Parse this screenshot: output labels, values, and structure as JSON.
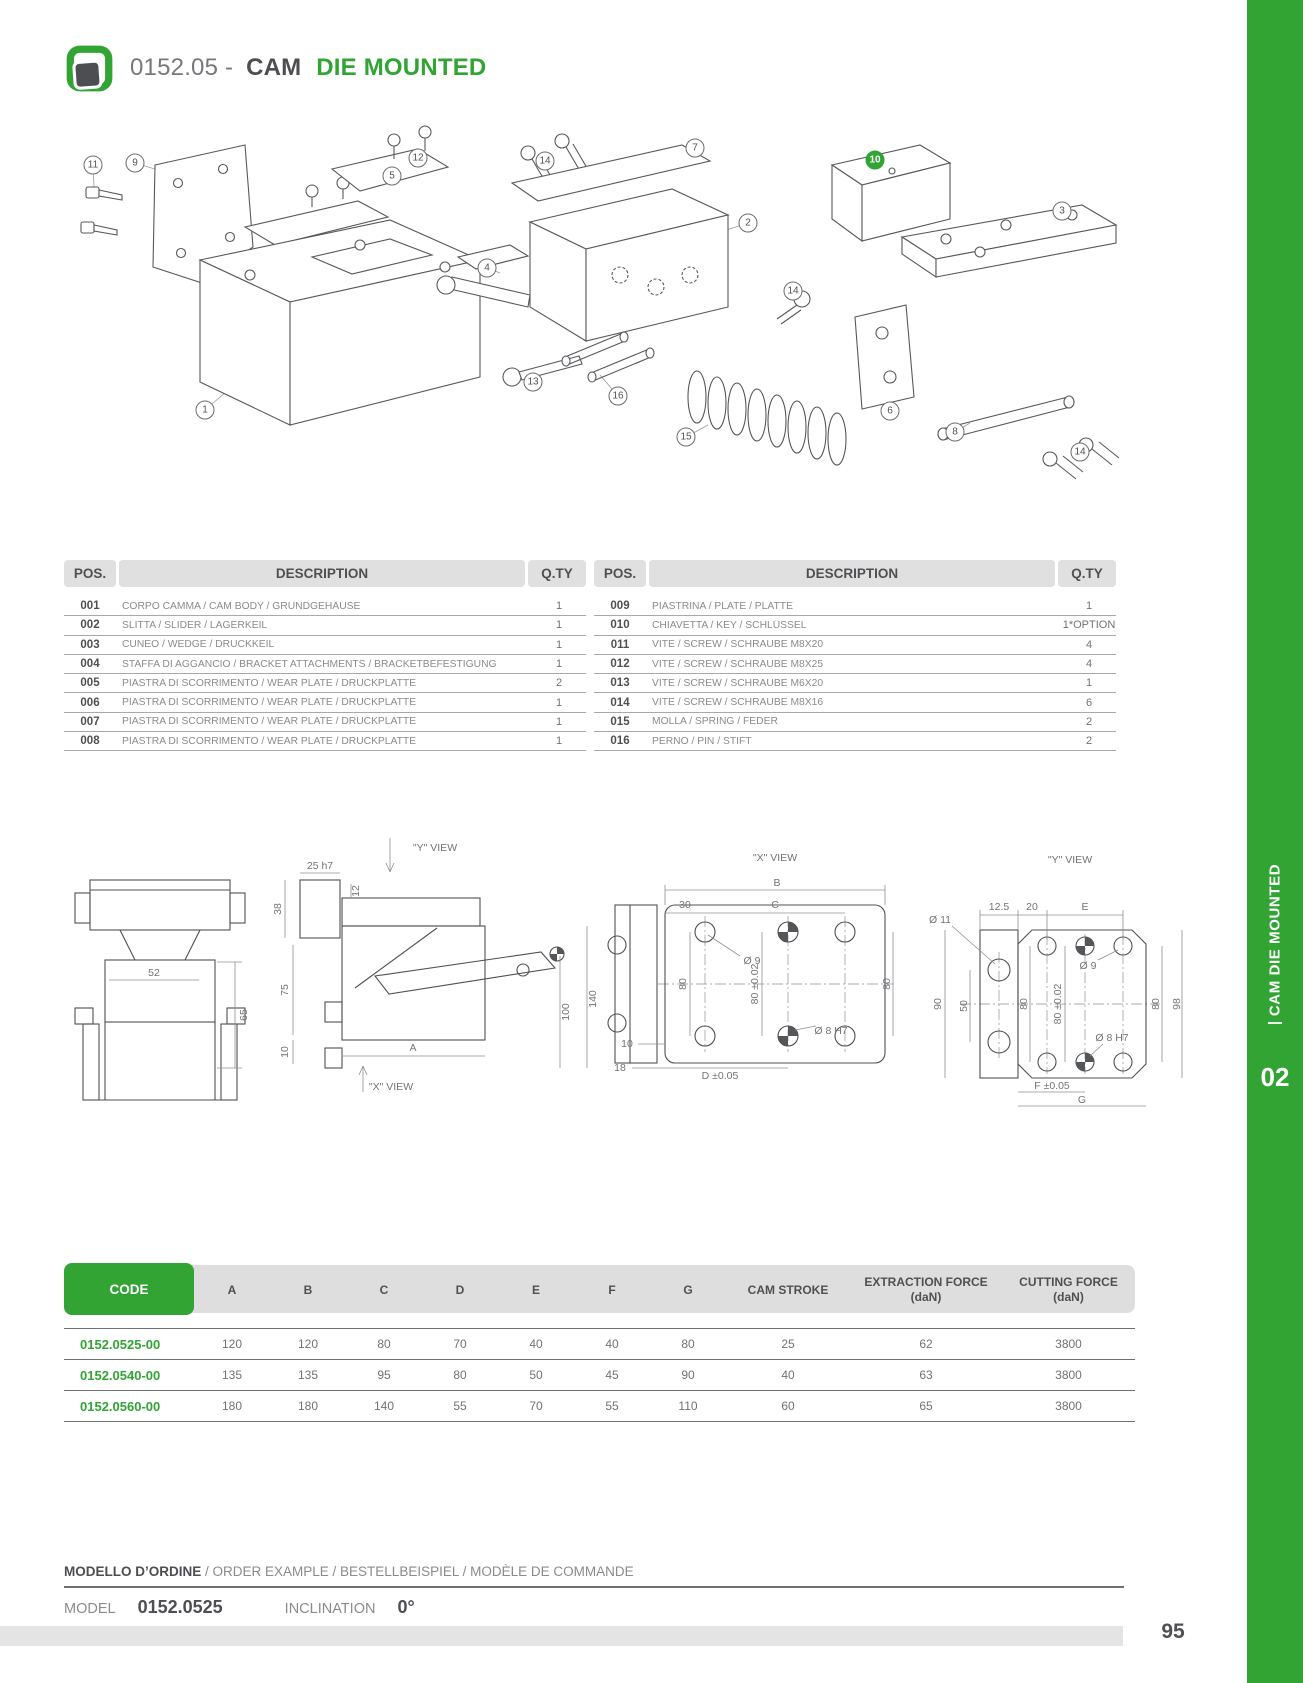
{
  "header": {
    "code": "0152.05 -",
    "title_dark": "CAM",
    "title_green": "DIE MOUNTED"
  },
  "sidebar": {
    "label": "CAM DIE MOUNTED",
    "chapter": "02"
  },
  "page": {
    "number": "95"
  },
  "exploded_view": {
    "callouts": [
      {
        "n": "11",
        "x": 33,
        "y": 40
      },
      {
        "n": "9",
        "x": 75,
        "y": 38
      },
      {
        "n": "12",
        "x": 358,
        "y": 33
      },
      {
        "n": "5",
        "x": 332,
        "y": 51
      },
      {
        "n": "14",
        "x": 485,
        "y": 36
      },
      {
        "n": "7",
        "x": 635,
        "y": 23
      },
      {
        "n": "2",
        "x": 688,
        "y": 98
      },
      {
        "n": "10",
        "x": 815,
        "y": 35,
        "g": true
      },
      {
        "n": "3",
        "x": 1002,
        "y": 86
      },
      {
        "n": "4",
        "x": 427,
        "y": 143
      },
      {
        "n": "14",
        "x": 733,
        "y": 166
      },
      {
        "n": "13",
        "x": 473,
        "y": 257
      },
      {
        "n": "16",
        "x": 558,
        "y": 271
      },
      {
        "n": "15",
        "x": 626,
        "y": 312
      },
      {
        "n": "1",
        "x": 145,
        "y": 285
      },
      {
        "n": "6",
        "x": 830,
        "y": 286
      },
      {
        "n": "8",
        "x": 895,
        "y": 307
      },
      {
        "n": "14",
        "x": 1020,
        "y": 327
      }
    ]
  },
  "parts_tables": {
    "headers": {
      "pos": "POS.",
      "description": "DESCRIPTION",
      "qty": "Q.TY"
    },
    "left_rows": [
      {
        "pos": "001",
        "desc": "CORPO CAMMA / CAM BODY / GRUNDGEHÄUSE",
        "qty": "1"
      },
      {
        "pos": "002",
        "desc": "SLITTA / SLIDER / LAGERKEIL",
        "qty": "1"
      },
      {
        "pos": "003",
        "desc": "CUNEO / WEDGE / DRUCKKEIL",
        "qty": "1"
      },
      {
        "pos": "004",
        "desc": "STAFFA DI AGGANCIO / BRACKET ATTACHMENTS / BRACKETBEFESTIGUNG",
        "qty": "1"
      },
      {
        "pos": "005",
        "desc": "PIASTRA DI SCORRIMENTO  /  WEAR PLATE /  DRUCKPLATTE",
        "qty": "2"
      },
      {
        "pos": "006",
        "desc": "PIASTRA DI SCORRIMENTO  /  WEAR PLATE /  DRUCKPLATTE",
        "qty": "1"
      },
      {
        "pos": "007",
        "desc": "PIASTRA DI SCORRIMENTO  /  WEAR PLATE /  DRUCKPLATTE",
        "qty": "1"
      },
      {
        "pos": "008",
        "desc": "PIASTRA DI SCORRIMENTO  /  WEAR PLATE /  DRUCKPLATTE",
        "qty": "1"
      }
    ],
    "right_rows": [
      {
        "pos": "009",
        "desc": "PIASTRINA / PLATE / PLATTE",
        "qty": "1"
      },
      {
        "pos": "010",
        "desc": "CHIAVETTA / KEY / SCHLÜSSEL",
        "qty": "1*OPTION"
      },
      {
        "pos": "011",
        "desc": "VITE / SCREW / SCHRAUBE M8X20",
        "qty": "4"
      },
      {
        "pos": "012",
        "desc": "VITE / SCREW / SCHRAUBE M8X25",
        "qty": "4"
      },
      {
        "pos": "013",
        "desc": "VITE / SCREW / SCHRAUBE M6X20",
        "qty": "1"
      },
      {
        "pos": "014",
        "desc": "VITE / SCREW / SCHRAUBE M8X16",
        "qty": "6"
      },
      {
        "pos": "015",
        "desc": "MOLLA / SPRING / FEDER",
        "qty": "2"
      },
      {
        "pos": "016",
        "desc": "PERNO / PIN / STIFT",
        "qty": "2"
      }
    ]
  },
  "dimension_views": {
    "front_view": {
      "labels": [
        {
          "t": "52",
          "x": 89,
          "y": 193,
          "r": 0
        },
        {
          "t": "65",
          "x": 179,
          "y": 235,
          "r": -90
        }
      ]
    },
    "side_view": {
      "labels": [
        {
          "t": "25  h7",
          "x": 65,
          "y": 86,
          "r": 0
        },
        {
          "t": "\"Y\"  VIEW",
          "x": 180,
          "y": 68,
          "r": 0
        },
        {
          "t": "12",
          "x": 101,
          "y": 111,
          "r": -90
        },
        {
          "t": "38",
          "x": 23,
          "y": 129,
          "r": -90
        },
        {
          "t": "75",
          "x": 30,
          "y": 210,
          "r": -90
        },
        {
          "t": "10",
          "x": 30,
          "y": 272,
          "r": -90
        },
        {
          "t": "100",
          "x": 311,
          "y": 232,
          "r": -90
        },
        {
          "t": "140",
          "x": 338,
          "y": 219,
          "r": -90
        },
        {
          "t": "A",
          "x": 158,
          "y": 268,
          "r": 0
        },
        {
          "t": "\"X\"  VIEW",
          "x": 136,
          "y": 307,
          "r": 0
        }
      ]
    },
    "x_view": {
      "labels": [
        {
          "t": "\"X\"  VIEW",
          "x": 175,
          "y": 78,
          "r": 0
        },
        {
          "t": "B",
          "x": 177,
          "y": 103,
          "r": 0
        },
        {
          "t": "30",
          "x": 85,
          "y": 125,
          "r": 0
        },
        {
          "t": "C",
          "x": 175,
          "y": 125,
          "r": 0
        },
        {
          "t": "Ø  9",
          "x": 152,
          "y": 181,
          "r": 0
        },
        {
          "t": "80",
          "x": 83,
          "y": 204,
          "r": -90
        },
        {
          "t": "80  ±0.02",
          "x": 155,
          "y": 204,
          "r": -90
        },
        {
          "t": "80",
          "x": 287,
          "y": 204,
          "r": -90
        },
        {
          "t": "Ø  8  H7",
          "x": 231,
          "y": 251,
          "r": 0
        },
        {
          "t": "10",
          "x": 27,
          "y": 264,
          "r": 0
        },
        {
          "t": "18",
          "x": 20,
          "y": 288,
          "r": 0
        },
        {
          "t": "D  ±0.05",
          "x": 120,
          "y": 296,
          "r": 0
        }
      ]
    },
    "y_view": {
      "labels": [
        {
          "t": "\"Y\"  VIEW",
          "x": 170,
          "y": 80,
          "r": 0
        },
        {
          "t": "Ø  11",
          "x": 40,
          "y": 140,
          "r": 0
        },
        {
          "t": "12.5",
          "x": 99,
          "y": 127,
          "r": 0
        },
        {
          "t": "20",
          "x": 132,
          "y": 127,
          "r": 0
        },
        {
          "t": "E",
          "x": 185,
          "y": 127,
          "r": 0
        },
        {
          "t": "Ø  9",
          "x": 188,
          "y": 186,
          "r": 0
        },
        {
          "t": "90",
          "x": 38,
          "y": 224,
          "r": -90
        },
        {
          "t": "50",
          "x": 64,
          "y": 226,
          "r": -90
        },
        {
          "t": "80",
          "x": 124,
          "y": 224,
          "r": -90
        },
        {
          "t": "80  ±0.02",
          "x": 158,
          "y": 224,
          "r": -90
        },
        {
          "t": "80",
          "x": 256,
          "y": 224,
          "r": -90
        },
        {
          "t": "98",
          "x": 277,
          "y": 224,
          "r": -90
        },
        {
          "t": "Ø  8  H7",
          "x": 212,
          "y": 258,
          "r": 0
        },
        {
          "t": "F  ±0.05",
          "x": 152,
          "y": 306,
          "r": 0
        },
        {
          "t": "G",
          "x": 182,
          "y": 320,
          "r": 0
        }
      ]
    }
  },
  "spec_table": {
    "columns": [
      "CODE",
      "A",
      "B",
      "C",
      "D",
      "E",
      "F",
      "G",
      "CAM STROKE",
      "EXTRACTION FORCE\n(daN)",
      "CUTTING FORCE\n(daN)"
    ],
    "rows": [
      {
        "code": "0152.0525-00",
        "values": [
          "120",
          "120",
          "80",
          "70",
          "40",
          "40",
          "80",
          "25",
          "62",
          "3800"
        ]
      },
      {
        "code": "0152.0540-00",
        "values": [
          "135",
          "135",
          "95",
          "80",
          "50",
          "45",
          "90",
          "40",
          "63",
          "3800"
        ]
      },
      {
        "code": "0152.0560-00",
        "values": [
          "180",
          "180",
          "140",
          "55",
          "70",
          "55",
          "110",
          "60",
          "65",
          "3800"
        ]
      }
    ]
  },
  "order_example": {
    "heading_bold": "MODELLO D’ORDINE",
    "heading_rest": " / ORDER EXAMPLE / BESTELLBEISPIEL / MODÈLE DE COMMANDE",
    "model_label": "MODEL",
    "model_value": "0152.0525",
    "inclination_label": "INCLINATION",
    "inclination_value": "0°"
  },
  "colors": {
    "green": "#31a434",
    "dark": "#515255",
    "gray": "#85868a"
  }
}
